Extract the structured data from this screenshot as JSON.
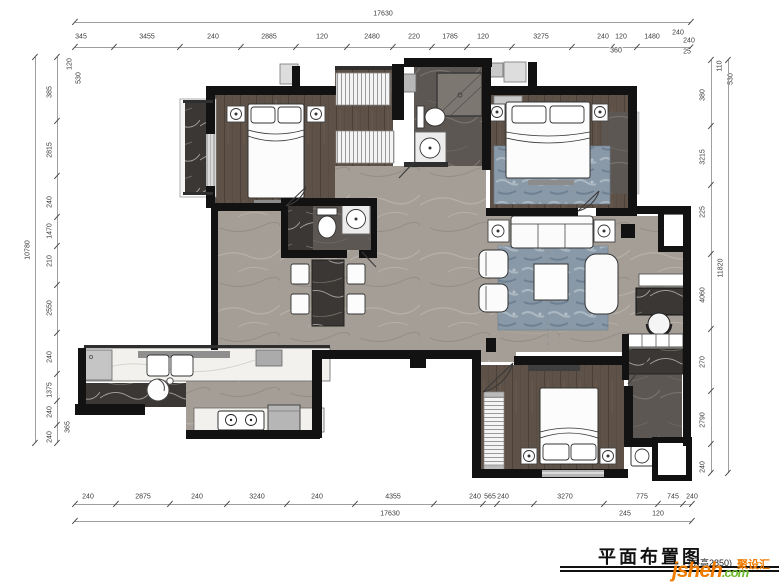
{
  "plan": {
    "title": "平面布置图",
    "height_note": "(层高2850)"
  },
  "watermark": {
    "brand": "jsheh",
    "tld": ".com",
    "cn": "聚设汇",
    "orange": "#f07d00",
    "green": "#6fb92c"
  },
  "dimensions": {
    "groups": [
      {
        "name": "top-overall",
        "orient": "h",
        "line": [
          75,
          22,
          691,
          22
        ],
        "end": true,
        "labels": [
          {
            "t": "17630",
            "x": 383,
            "y": 14
          }
        ]
      },
      {
        "name": "top-chain",
        "orient": "h",
        "line": [
          75,
          47,
          691,
          47
        ],
        "end": true,
        "labels": [
          {
            "t": "345",
            "x": 81,
            "y": 37
          },
          {
            "t": "3455",
            "x": 147,
            "y": 37
          },
          {
            "t": "240",
            "x": 213,
            "y": 37
          },
          {
            "t": "2885",
            "x": 269,
            "y": 37
          },
          {
            "t": "120",
            "x": 322,
            "y": 37
          },
          {
            "t": "2480",
            "x": 372,
            "y": 37
          },
          {
            "t": "220",
            "x": 414,
            "y": 37
          },
          {
            "t": "1785",
            "x": 450,
            "y": 37
          },
          {
            "t": "120",
            "x": 483,
            "y": 37
          },
          {
            "t": "3275",
            "x": 541,
            "y": 37
          },
          {
            "t": "240",
            "x": 603,
            "y": 37
          },
          {
            "t": "120",
            "x": 621,
            "y": 37
          },
          {
            "t": "1480",
            "x": 652,
            "y": 37
          }
        ]
      },
      {
        "name": "top-sub",
        "orient": "h",
        "labels": [
          {
            "t": "240",
            "x": 678,
            "y": 33
          },
          {
            "t": "240",
            "x": 689,
            "y": 41
          },
          {
            "t": "360",
            "x": 616,
            "y": 51
          },
          {
            "t": "25",
            "x": 687,
            "y": 52
          }
        ]
      },
      {
        "name": "bottom-chain",
        "orient": "h",
        "line": [
          75,
          504,
          692,
          504
        ],
        "end": true,
        "labels": [
          {
            "t": "240",
            "x": 88,
            "y": 497
          },
          {
            "t": "2875",
            "x": 143,
            "y": 497
          },
          {
            "t": "240",
            "x": 197,
            "y": 497
          },
          {
            "t": "3240",
            "x": 257,
            "y": 497
          },
          {
            "t": "240",
            "x": 317,
            "y": 497
          },
          {
            "t": "4355",
            "x": 393,
            "y": 497
          },
          {
            "t": "240",
            "x": 475,
            "y": 497
          },
          {
            "t": "565",
            "x": 490,
            "y": 497
          },
          {
            "t": "240",
            "x": 503,
            "y": 497
          },
          {
            "t": "3270",
            "x": 565,
            "y": 497
          },
          {
            "t": "775",
            "x": 642,
            "y": 497
          },
          {
            "t": "745",
            "x": 673,
            "y": 497
          },
          {
            "t": "240",
            "x": 692,
            "y": 497
          }
        ]
      },
      {
        "name": "bottom-sub",
        "orient": "h",
        "labels": [
          {
            "t": "245",
            "x": 625,
            "y": 514
          },
          {
            "t": "120",
            "x": 658,
            "y": 514
          }
        ]
      },
      {
        "name": "bottom-overall",
        "orient": "h",
        "line": [
          75,
          521,
          692,
          521
        ],
        "end": true,
        "labels": [
          {
            "t": "17630",
            "x": 390,
            "y": 514
          }
        ]
      },
      {
        "name": "left-chain",
        "orient": "v",
        "line": [
          57,
          57,
          57,
          443
        ],
        "end": true,
        "labels": [
          {
            "t": "385",
            "x": 50,
            "y": 92
          },
          {
            "t": "2815",
            "x": 50,
            "y": 150
          },
          {
            "t": "240",
            "x": 50,
            "y": 202
          },
          {
            "t": "1470",
            "x": 50,
            "y": 231
          },
          {
            "t": "210",
            "x": 50,
            "y": 261
          },
          {
            "t": "2550",
            "x": 50,
            "y": 308
          },
          {
            "t": "240",
            "x": 50,
            "y": 357
          },
          {
            "t": "1375",
            "x": 50,
            "y": 390
          },
          {
            "t": "240",
            "x": 50,
            "y": 412
          },
          {
            "t": "240",
            "x": 50,
            "y": 437
          }
        ]
      },
      {
        "name": "left-sub",
        "orient": "v",
        "labels": [
          {
            "t": "120",
            "x": 70,
            "y": 64
          },
          {
            "t": "530",
            "x": 79,
            "y": 78
          },
          {
            "t": "365",
            "x": 68,
            "y": 427
          }
        ]
      },
      {
        "name": "left-overall",
        "orient": "v",
        "line": [
          35,
          57,
          35,
          443
        ],
        "end": true,
        "labels": [
          {
            "t": "10780",
            "x": 28,
            "y": 250
          }
        ]
      },
      {
        "name": "right-chain",
        "orient": "v",
        "line": [
          711,
          60,
          711,
          473
        ],
        "end": true,
        "labels": [
          {
            "t": "380",
            "x": 703,
            "y": 95
          },
          {
            "t": "3215",
            "x": 703,
            "y": 157
          },
          {
            "t": "225",
            "x": 703,
            "y": 212
          },
          {
            "t": "4060",
            "x": 703,
            "y": 295
          },
          {
            "t": "270",
            "x": 703,
            "y": 362
          },
          {
            "t": "2790",
            "x": 703,
            "y": 420
          },
          {
            "t": "240",
            "x": 703,
            "y": 467
          }
        ]
      },
      {
        "name": "right-sub",
        "orient": "v",
        "labels": [
          {
            "t": "110",
            "x": 720,
            "y": 66
          },
          {
            "t": "530",
            "x": 731,
            "y": 79
          }
        ]
      },
      {
        "name": "right-overall",
        "orient": "v",
        "line": [
          728,
          60,
          728,
          473
        ],
        "end": true,
        "labels": [
          {
            "t": "11820",
            "x": 721,
            "y": 268
          }
        ]
      }
    ]
  }
}
